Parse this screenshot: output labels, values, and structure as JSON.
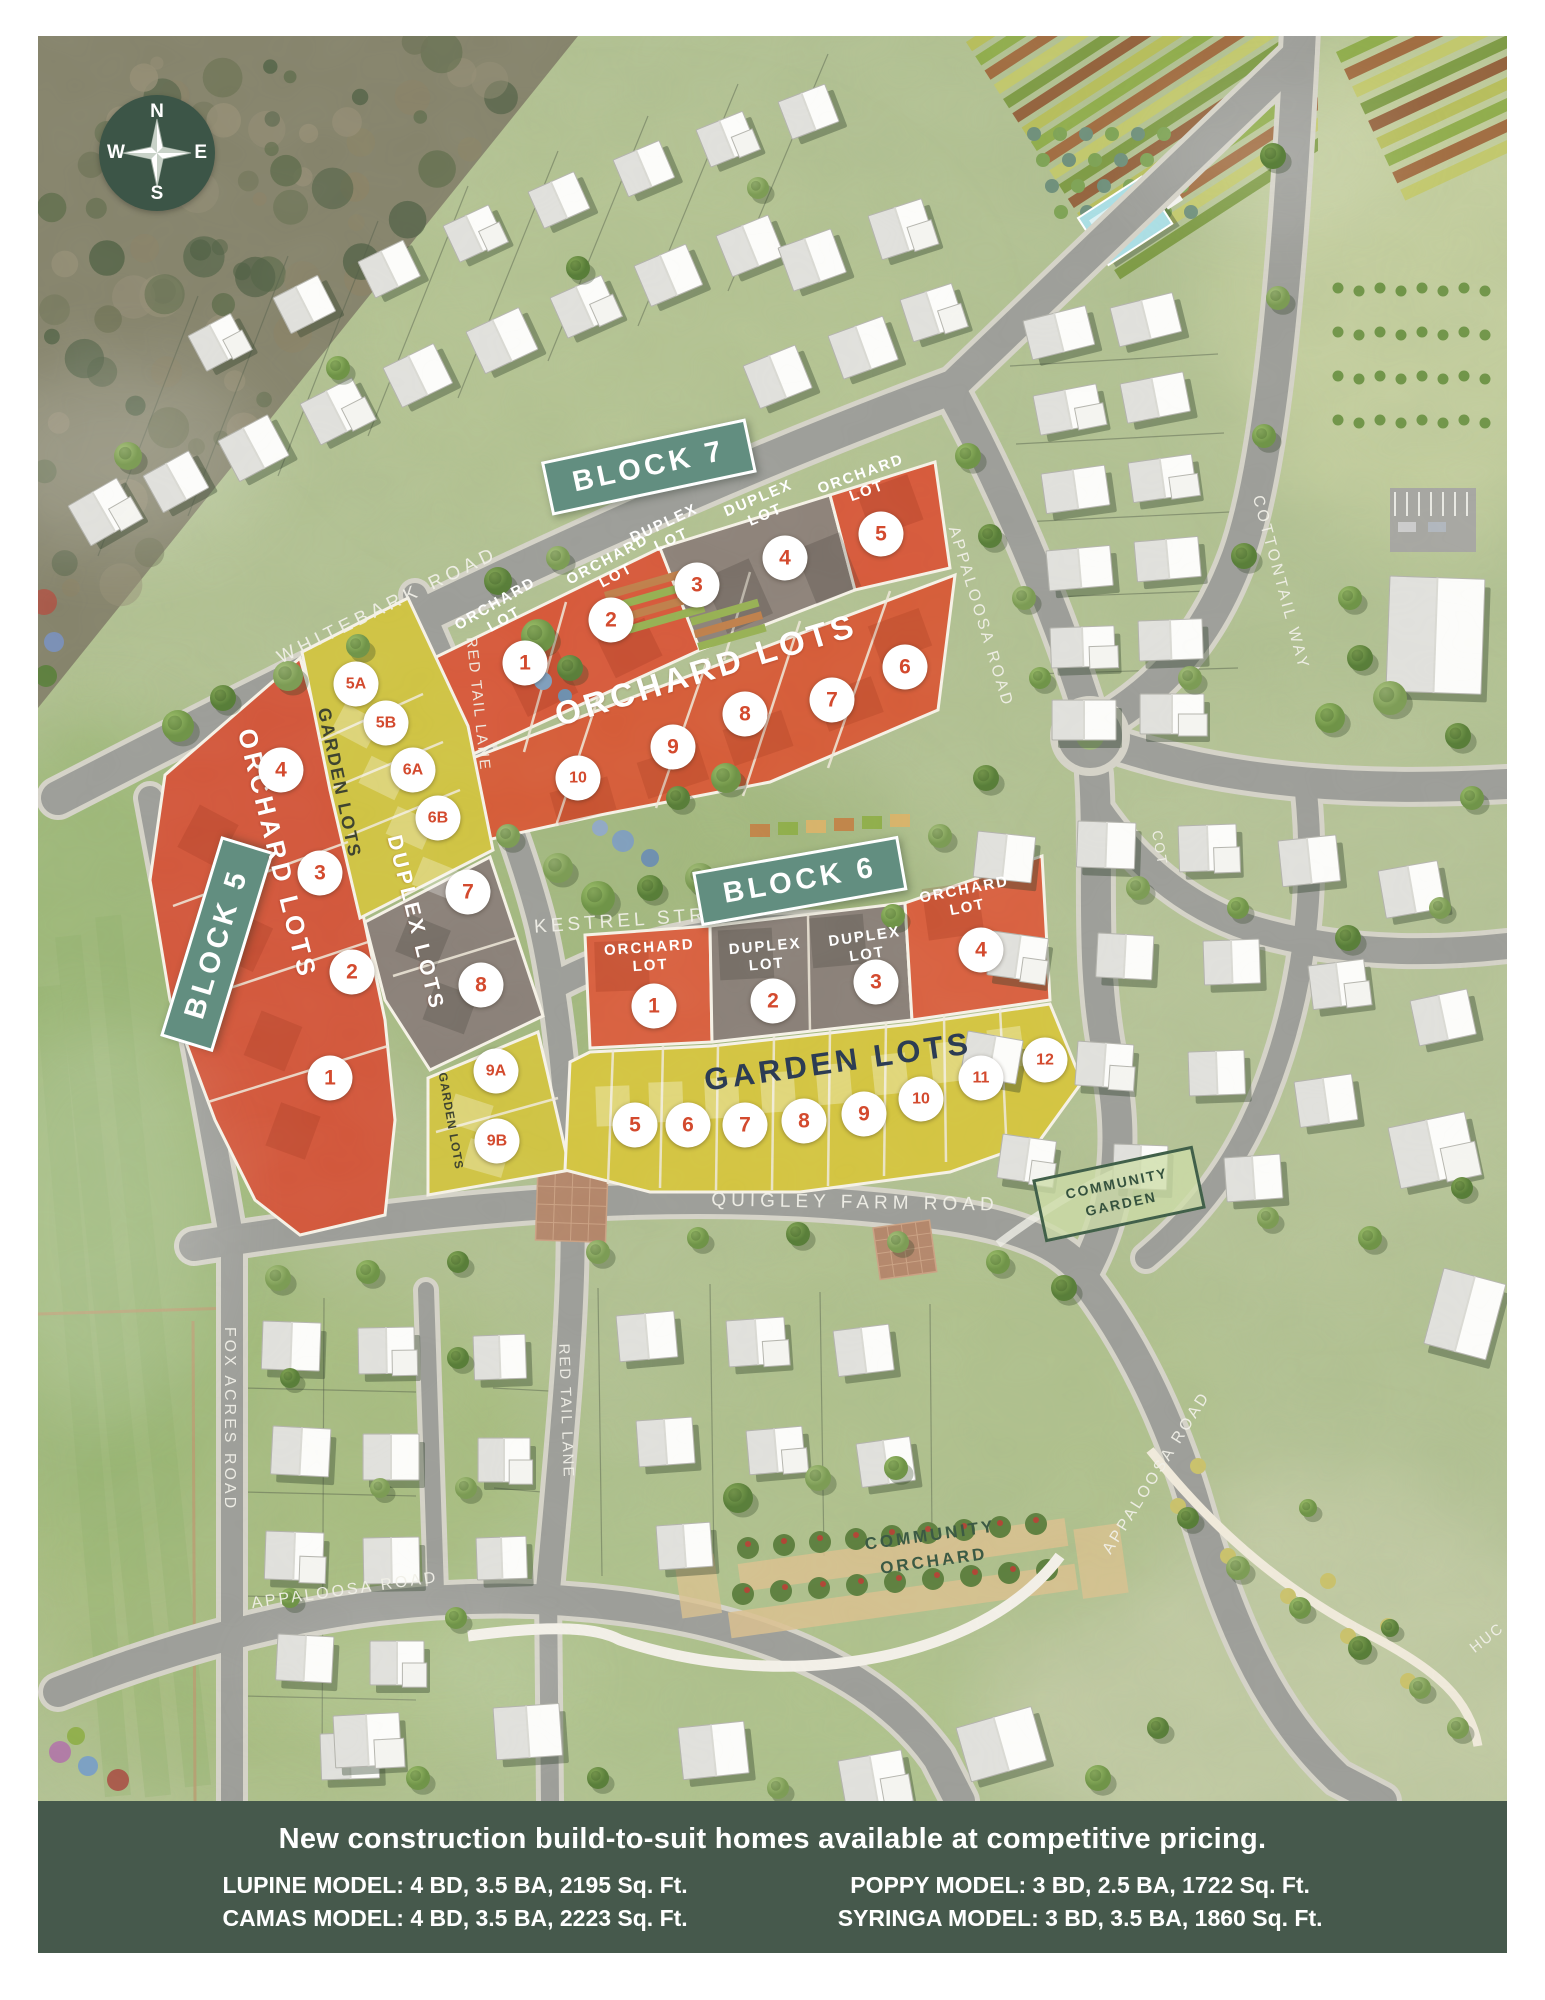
{
  "map": {
    "compass": {
      "n": "N",
      "e": "E",
      "s": "S",
      "w": "W"
    },
    "block_labels": [
      {
        "text": "BLOCK 7",
        "x": 611,
        "y": 431,
        "rot": -12
      },
      {
        "text": "BLOCK 6",
        "x": 762,
        "y": 845,
        "rot": -10
      },
      {
        "text": "BLOCK 5",
        "x": 179,
        "y": 908,
        "rot": -73
      }
    ],
    "street_labels": [
      {
        "text": "WHITEBARK ROAD",
        "x": 350,
        "y": 570,
        "rot": -26,
        "size": 19,
        "ls": 5
      },
      {
        "text": "RED TAIL LANE",
        "x": 440,
        "y": 668,
        "rot": 84,
        "size": 15,
        "ls": 2
      },
      {
        "text": "KESTREL STREET",
        "x": 607,
        "y": 884,
        "rot": -4,
        "size": 19,
        "ls": 4
      },
      {
        "text": "APPALOOSA ROAD",
        "x": 942,
        "y": 581,
        "rot": 73,
        "size": 16,
        "ls": 3
      },
      {
        "text": "COTTONTAIL WAY",
        "x": 1242,
        "y": 547,
        "rot": 75,
        "size": 16,
        "ls": 3
      },
      {
        "text": "COT",
        "x": 1122,
        "y": 812,
        "rot": 80,
        "size": 14,
        "ls": 2
      },
      {
        "text": "QUIGLEY FARM ROAD",
        "x": 817,
        "y": 1167,
        "rot": 1,
        "size": 19,
        "ls": 5
      },
      {
        "text": "FOX ACRES ROAD",
        "x": 191,
        "y": 1383,
        "rot": 90,
        "size": 16,
        "ls": 3
      },
      {
        "text": "RED TAIL LANE",
        "x": 528,
        "y": 1375,
        "rot": 88,
        "size": 15,
        "ls": 2
      },
      {
        "text": "APPALOOSA ROAD",
        "x": 307,
        "y": 1555,
        "rot": -8,
        "size": 16,
        "ls": 3
      },
      {
        "text": "APPALOOSA ROAD",
        "x": 1119,
        "y": 1437,
        "rot": -58,
        "size": 16,
        "ls": 3
      },
      {
        "text": "HUC",
        "x": 1449,
        "y": 1602,
        "rot": -38,
        "size": 15,
        "ls": 2
      }
    ],
    "area_labels": [
      {
        "text": "ORCHARD LOTS",
        "x": 668,
        "y": 634,
        "rot": -17,
        "size": 33,
        "ls": 4,
        "color": "white"
      },
      {
        "text": "ORCHARD LOTS",
        "x": 239,
        "y": 818,
        "rot": 76,
        "size": 26,
        "ls": 4,
        "color": "white"
      },
      {
        "text": "DUPLEX LOTS",
        "x": 377,
        "y": 887,
        "rot": 76,
        "size": 21,
        "ls": 3,
        "color": "white"
      },
      {
        "text": "GARDEN LOTS",
        "x": 301,
        "y": 747,
        "rot": 78,
        "size": 18,
        "ls": 2,
        "color": "dark"
      },
      {
        "text": "GARDEN LOTS",
        "x": 413,
        "y": 1085,
        "rot": 80,
        "size": 12,
        "ls": 1,
        "color": "dark"
      },
      {
        "text": "GARDEN LOTS",
        "x": 800,
        "y": 1026,
        "rot": -8,
        "size": 31,
        "ls": 4,
        "color": "navy"
      }
    ],
    "lot_labels": [
      {
        "text": "ORCHARD LOT",
        "x": 462,
        "y": 576,
        "rot": -30
      },
      {
        "text": "ORCHARD LOT",
        "x": 574,
        "y": 532,
        "rot": -28
      },
      {
        "text": "DUPLEX LOT",
        "x": 630,
        "y": 496,
        "rot": -25
      },
      {
        "text": "DUPLEX LOT",
        "x": 724,
        "y": 471,
        "rot": -23
      },
      {
        "text": "ORCHARD LOT",
        "x": 826,
        "y": 447,
        "rot": -20
      },
      {
        "text": "ORCHARD LOT",
        "x": 612,
        "y": 921,
        "rot": -4
      },
      {
        "text": "DUPLEX LOT",
        "x": 728,
        "y": 920,
        "rot": -5
      },
      {
        "text": "DUPLEX LOT",
        "x": 828,
        "y": 910,
        "rot": -8
      },
      {
        "text": "ORCHARD LOT",
        "x": 928,
        "y": 863,
        "rot": -11
      }
    ],
    "lot_markers": [
      {
        "block": "7",
        "label": "1",
        "x": 487,
        "y": 627
      },
      {
        "block": "7",
        "label": "2",
        "x": 573,
        "y": 584
      },
      {
        "block": "7",
        "label": "3",
        "x": 659,
        "y": 549
      },
      {
        "block": "7",
        "label": "4",
        "x": 747,
        "y": 522
      },
      {
        "block": "7",
        "label": "5",
        "x": 843,
        "y": 498
      },
      {
        "block": "7",
        "label": "6",
        "x": 867,
        "y": 631
      },
      {
        "block": "7",
        "label": "7",
        "x": 794,
        "y": 664
      },
      {
        "block": "7",
        "label": "8",
        "x": 707,
        "y": 678
      },
      {
        "block": "7",
        "label": "9",
        "x": 635,
        "y": 711
      },
      {
        "block": "7",
        "label": "10",
        "x": 540,
        "y": 742
      },
      {
        "block": "5",
        "label": "4",
        "x": 243,
        "y": 734
      },
      {
        "block": "5",
        "label": "3",
        "x": 282,
        "y": 837
      },
      {
        "block": "5",
        "label": "2",
        "x": 314,
        "y": 936
      },
      {
        "block": "5",
        "label": "1",
        "x": 292,
        "y": 1042
      },
      {
        "block": "5",
        "label": "5A",
        "x": 318,
        "y": 648
      },
      {
        "block": "5",
        "label": "5B",
        "x": 348,
        "y": 687
      },
      {
        "block": "5",
        "label": "6A",
        "x": 375,
        "y": 734
      },
      {
        "block": "5",
        "label": "6B",
        "x": 400,
        "y": 782
      },
      {
        "block": "5",
        "label": "7",
        "x": 430,
        "y": 856
      },
      {
        "block": "5",
        "label": "8",
        "x": 443,
        "y": 949
      },
      {
        "block": "5",
        "label": "9A",
        "x": 458,
        "y": 1035
      },
      {
        "block": "5",
        "label": "9B",
        "x": 459,
        "y": 1105
      },
      {
        "block": "6",
        "label": "1",
        "x": 616,
        "y": 970
      },
      {
        "block": "6",
        "label": "2",
        "x": 735,
        "y": 965
      },
      {
        "block": "6",
        "label": "3",
        "x": 838,
        "y": 946
      },
      {
        "block": "6",
        "label": "4",
        "x": 943,
        "y": 914
      },
      {
        "block": "6",
        "label": "5",
        "x": 597,
        "y": 1089
      },
      {
        "block": "6",
        "label": "6",
        "x": 650,
        "y": 1089
      },
      {
        "block": "6",
        "label": "7",
        "x": 707,
        "y": 1089
      },
      {
        "block": "6",
        "label": "8",
        "x": 766,
        "y": 1085
      },
      {
        "block": "6",
        "label": "9",
        "x": 826,
        "y": 1078
      },
      {
        "block": "6",
        "label": "10",
        "x": 883,
        "y": 1063
      },
      {
        "block": "6",
        "label": "11",
        "x": 943,
        "y": 1042
      },
      {
        "block": "6",
        "label": "12",
        "x": 1007,
        "y": 1024
      }
    ],
    "signs": [
      {
        "text": "COMMUNITY GARDEN",
        "x": 1081,
        "y": 1158,
        "rot": -12,
        "style": "boxed"
      },
      {
        "text": "COMMUNITY ORCHARD",
        "x": 894,
        "y": 1512,
        "rot": -8,
        "style": "plain"
      }
    ]
  },
  "footer": {
    "headline": "New construction build-to-suit homes available at competitive pricing.",
    "columns": [
      [
        "LUPINE MODEL: 4 BD, 3.5 BA, 2195 Sq. Ft.",
        "CAMAS MODEL: 4 BD, 3.5 BA, 2223 Sq. Ft."
      ],
      [
        "POPPY MODEL: 3 BD, 2.5 BA, 1722 Sq. Ft.",
        "SYRINGA MODEL: 3 BD, 3.5 BA, 1860 Sq. Ft."
      ]
    ]
  }
}
